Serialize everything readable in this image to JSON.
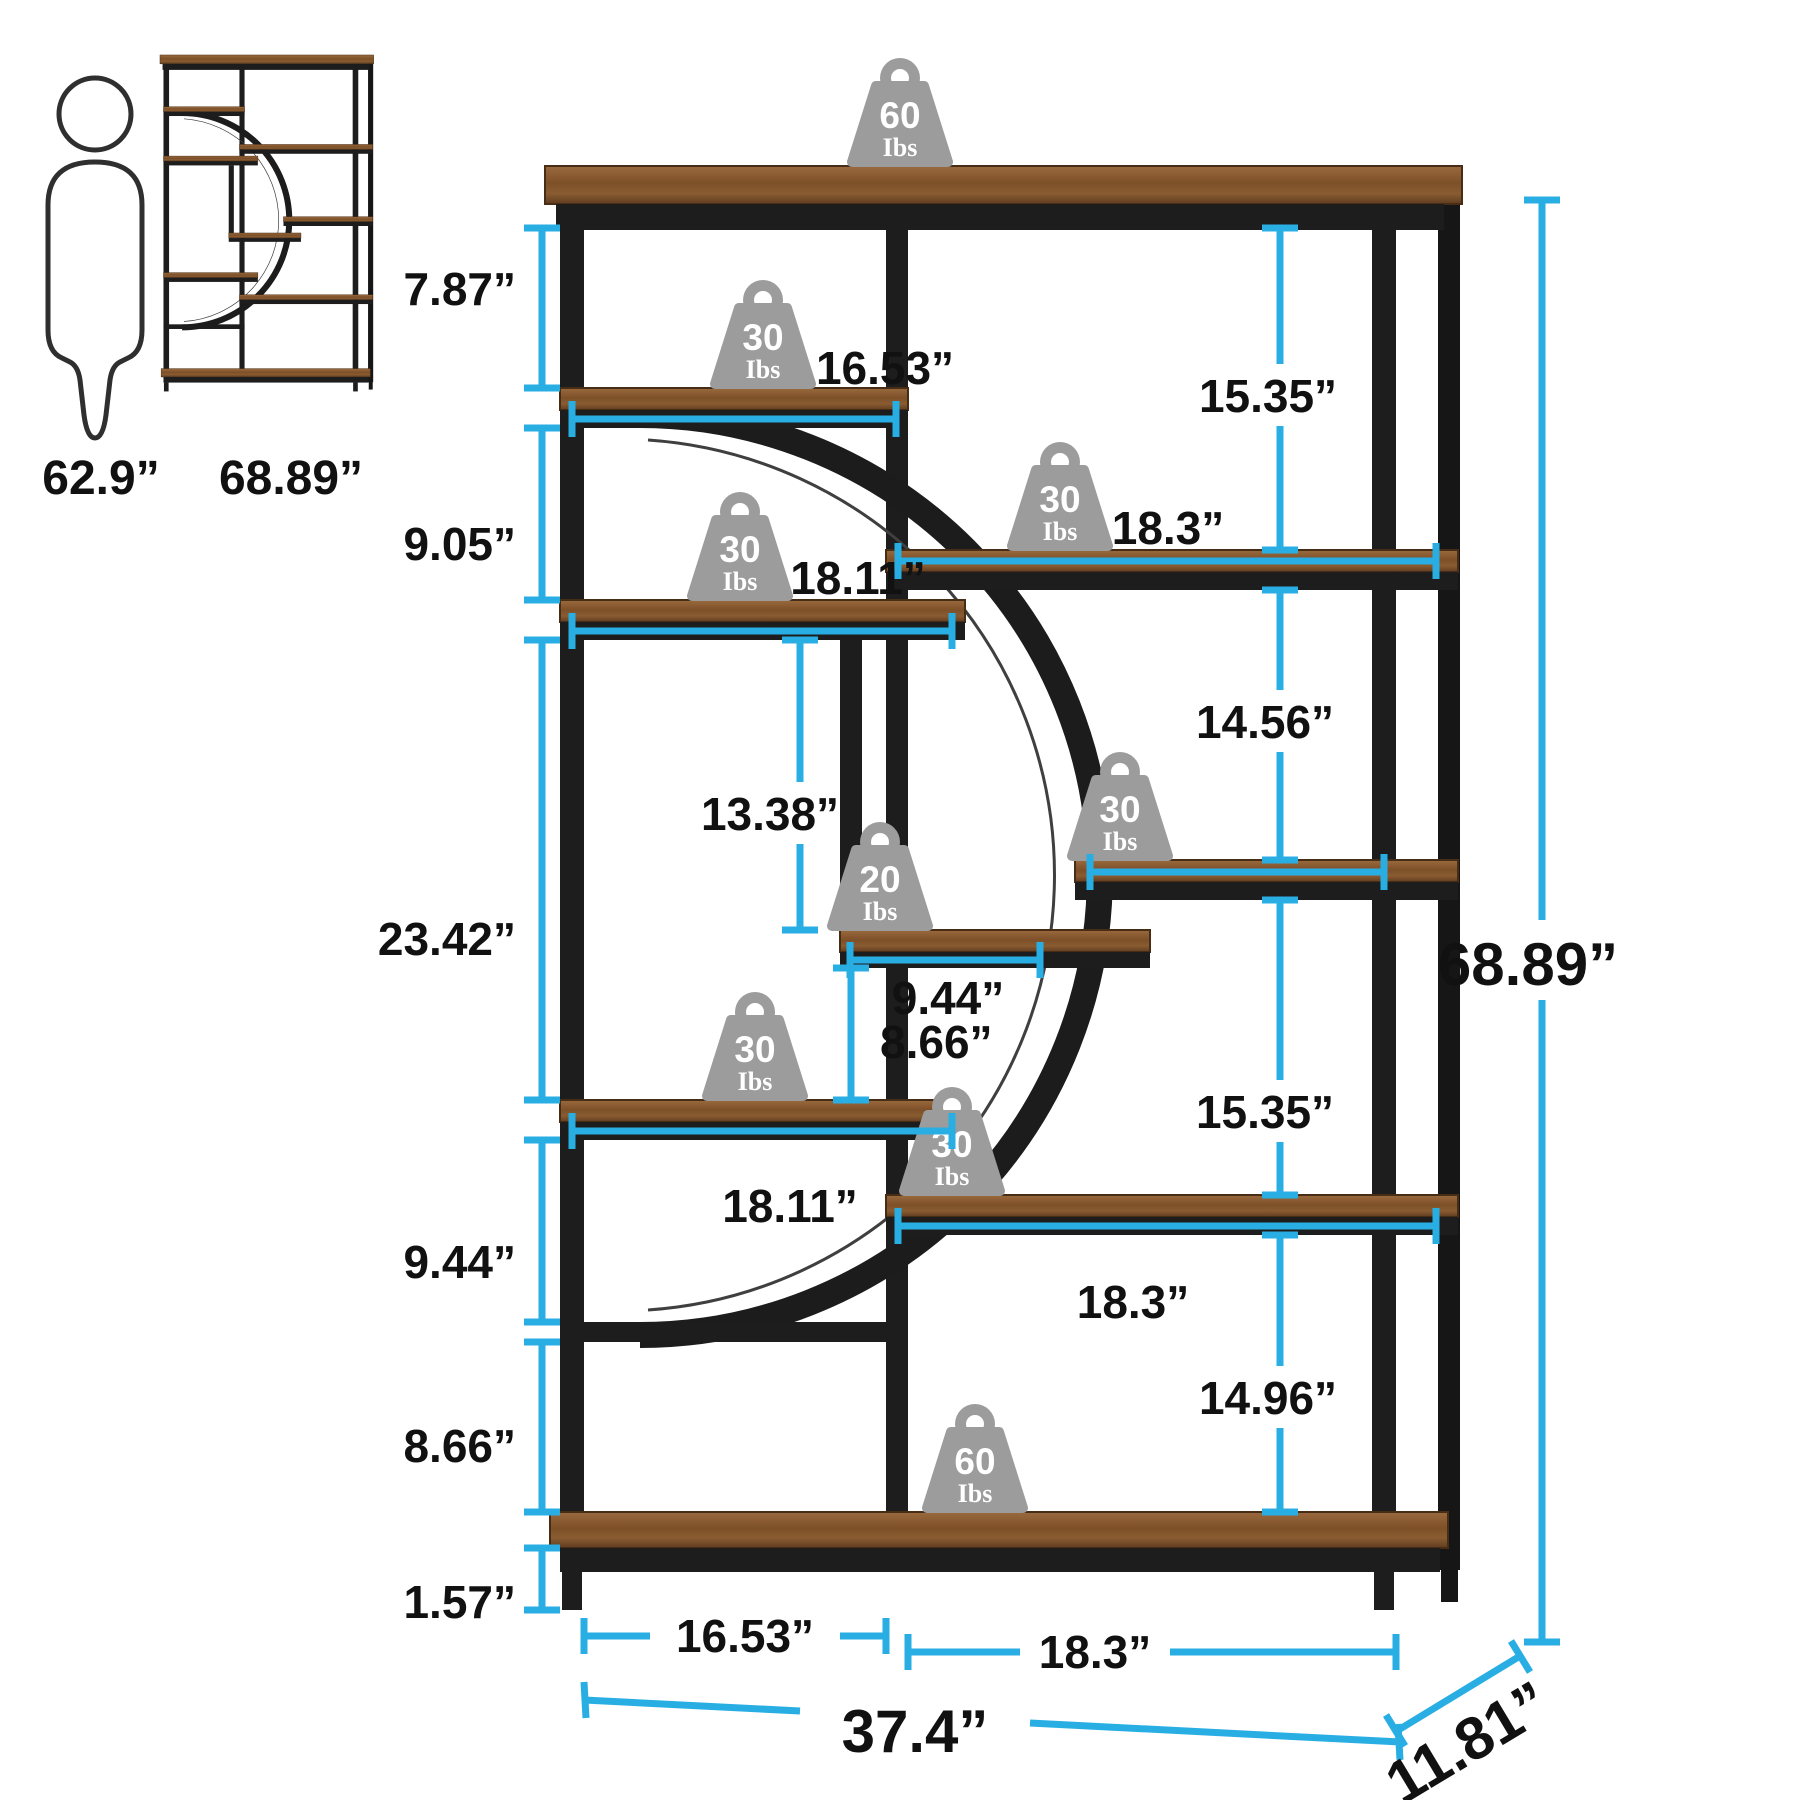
{
  "reference": {
    "person_height": "62.9”",
    "bookcase_height": "68.89”"
  },
  "overall": {
    "height": "68.89”",
    "width": "37.4”",
    "depth": "11.81”"
  },
  "left_gaps": [
    "7.87”",
    "9.05”",
    "23.42”",
    "9.44”",
    "8.66”",
    "1.57”"
  ],
  "right_gaps": [
    "15.35”",
    "14.56”",
    "15.35”",
    "14.96”"
  ],
  "shelf_widths": {
    "shelf_a": "16.53”",
    "shelf_b": "18.11”",
    "shelf_c": "18.11”",
    "shelf_d": "18.3”",
    "shelf_f": "18.3”",
    "small_shelf_width": "9.44”",
    "small_shelf_column_height": "13.38”",
    "small_shelf_gap_below": "8.66”",
    "bottom_left_section": "16.53”",
    "bottom_right_section": "18.3”"
  },
  "weights": {
    "top": {
      "value": "60",
      "unit": "Ibs"
    },
    "shelf_a": {
      "value": "30",
      "unit": "Ibs"
    },
    "shelf_d": {
      "value": "30",
      "unit": "Ibs"
    },
    "shelf_b": {
      "value": "30",
      "unit": "Ibs"
    },
    "shelf_e": {
      "value": "30",
      "unit": "Ibs"
    },
    "small_shelf": {
      "value": "20",
      "unit": "Ibs"
    },
    "shelf_c": {
      "value": "30",
      "unit": "Ibs"
    },
    "shelf_f": {
      "value": "30",
      "unit": "Ibs"
    },
    "bottom": {
      "value": "60",
      "unit": "Ibs"
    }
  },
  "colors": {
    "accent": "#29AEE4",
    "frame": "#1d1d1d",
    "wood_light": "#9a6a3e",
    "wood_dark": "#6e4525",
    "weight_gray": "#9c9c9c",
    "text": "#111111"
  }
}
